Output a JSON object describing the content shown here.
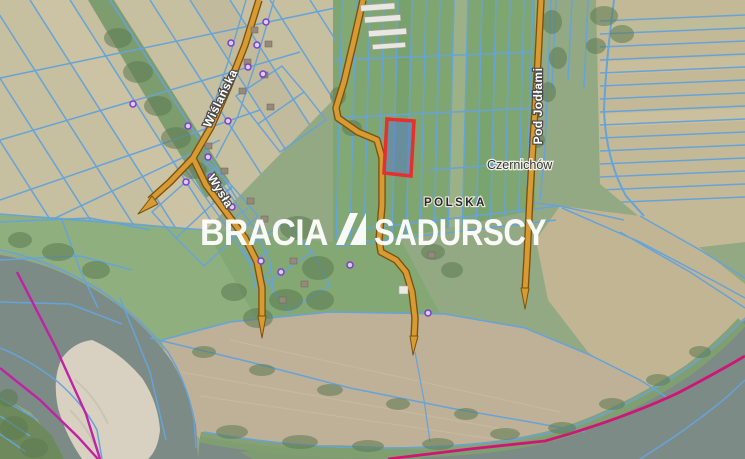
{
  "map": {
    "labels": {
      "road_wislanska": "Wiślańska",
      "road_wysla": "Wysła",
      "road_pod_jodlami": "Pod Jodłami",
      "town": "Czernichów",
      "country": "POLSKA"
    },
    "watermark": {
      "brand_left": "BRACIA",
      "brand_right": "SADURSCY"
    },
    "highlighted_parcel": {
      "outline_color": "#e62f2f",
      "fill_color": "#5b7fc4"
    },
    "colors": {
      "road_fill": "#d89a33",
      "road_casing": "#7a520e",
      "parcel_line": "#66a3d8",
      "admin_boundary": "#c121a5",
      "river_boundary": "#cf1676",
      "water": "#7c8b85",
      "sandbank": "#d8d1c2",
      "watermark_text": "#ffffff",
      "address_point": "#7b3fc2"
    }
  }
}
